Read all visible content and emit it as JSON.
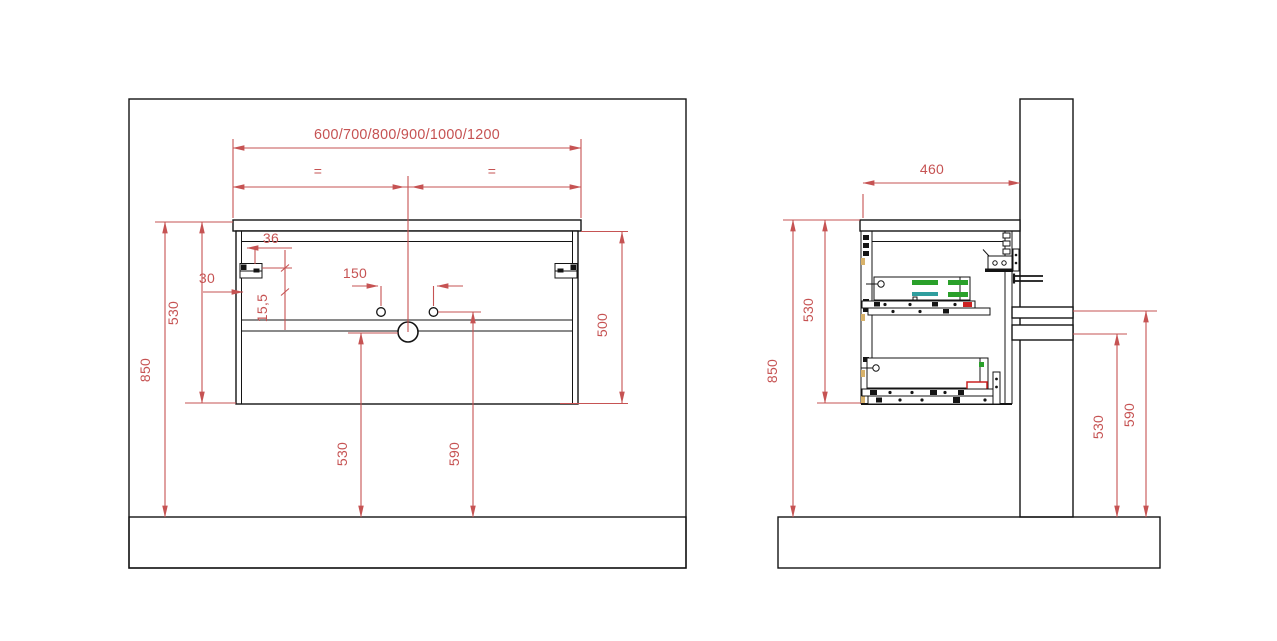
{
  "colors": {
    "dimension_red": "#c65353",
    "hatch_red": "#cf6b6b",
    "line_black": "#141414",
    "accent_green": "#2aa02a",
    "accent_teal": "#2f9e9e",
    "accent_red": "#cc2222",
    "accent_tan": "#d8b26a",
    "background": "#ffffff"
  },
  "front_view": {
    "width_options": "600/700/800/900/1000/1200",
    "equal_left": "=",
    "equal_right": "=",
    "bracket_inset": "36",
    "side_clearance": "30",
    "faucet_hole_spacing": "150",
    "bracket_drop": "15,5",
    "height_with_top": "530",
    "mounting_height": "850",
    "carcass_height": "500",
    "drain_height_from_floor": "530",
    "faucet_height_from_floor": "590"
  },
  "side_view": {
    "depth": "460",
    "mounting_height": "850",
    "height_with_top": "530",
    "drain_pipe_height": "530",
    "supply_pipe_height": "590"
  }
}
